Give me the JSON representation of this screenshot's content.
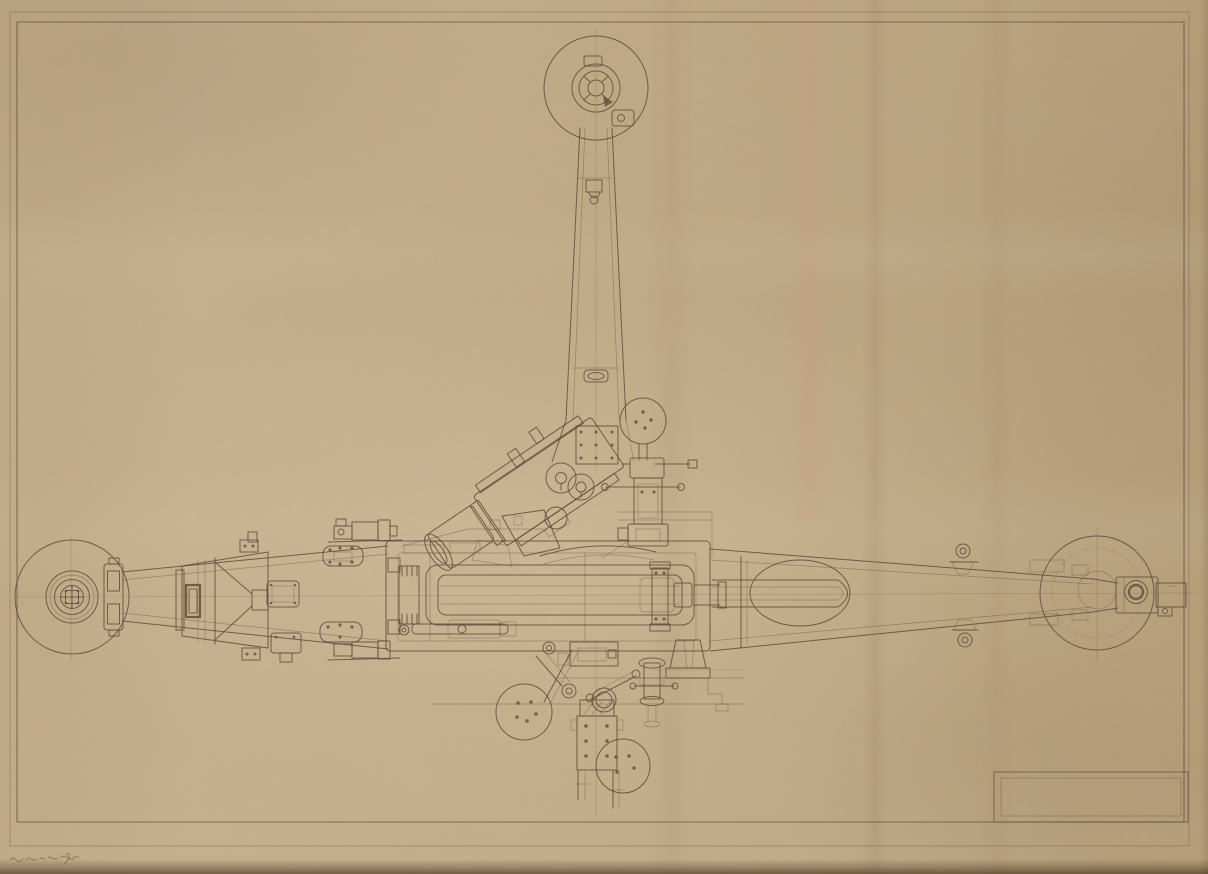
{
  "sheet": {
    "type": "scanned-engineering-drawing",
    "subject": "Towed artillery gun carriage — plan view",
    "paper_color": "#c3ab8a",
    "ink_color": "#5c4731",
    "border_color": "#6b5438",
    "title_block": {
      "text": ""
    },
    "pencil_note": {
      "text": ""
    }
  }
}
